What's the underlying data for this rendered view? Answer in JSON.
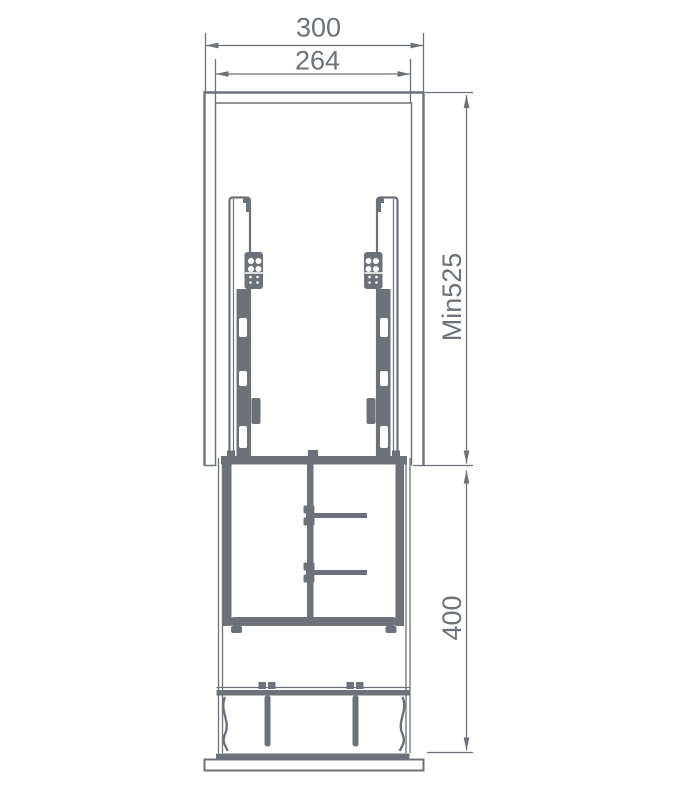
{
  "drawing": {
    "line_color": "#6d727a",
    "background_color": "#ffffff",
    "dimensions": {
      "top_outer_width": "300",
      "top_inner_width": "264",
      "right_upper_height": "Min525",
      "right_lower_height": "400"
    }
  }
}
